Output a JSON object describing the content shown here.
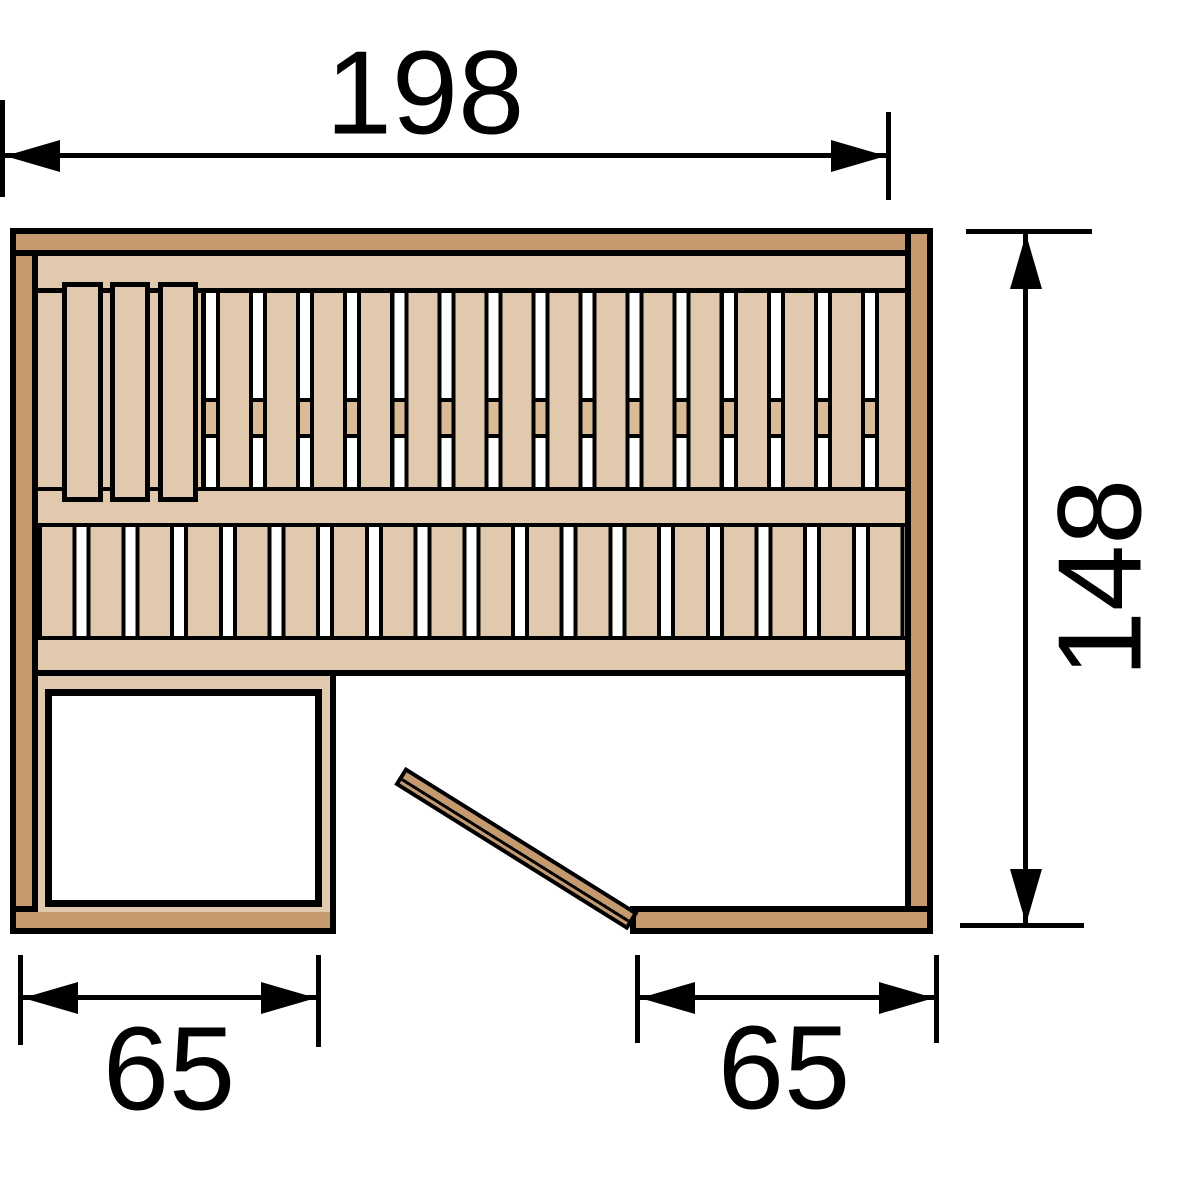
{
  "diagram": {
    "title": "Sauna floor plan (top view)",
    "dimensions": {
      "width": {
        "label": "198",
        "value": 198
      },
      "depth": {
        "label": "148",
        "value": 148
      },
      "bench": {
        "label": "65",
        "value": 65
      },
      "door": {
        "label": "65",
        "value": 65
      }
    },
    "colors": {
      "wall_wood": "#c49a6e",
      "bench_wood": "#e0c9ad",
      "support_wood": "#d9bc95",
      "outline": "#000000",
      "floor": "#ffffff"
    },
    "elements": {
      "upper_bench_headrest_slats": 3,
      "upper_bench_slats": 14,
      "lower_bench_slats": 18,
      "left_platform": "open rectangular platform at bottom left",
      "door_leaf": "door leaf shown ajar at bottom-right opening"
    }
  }
}
